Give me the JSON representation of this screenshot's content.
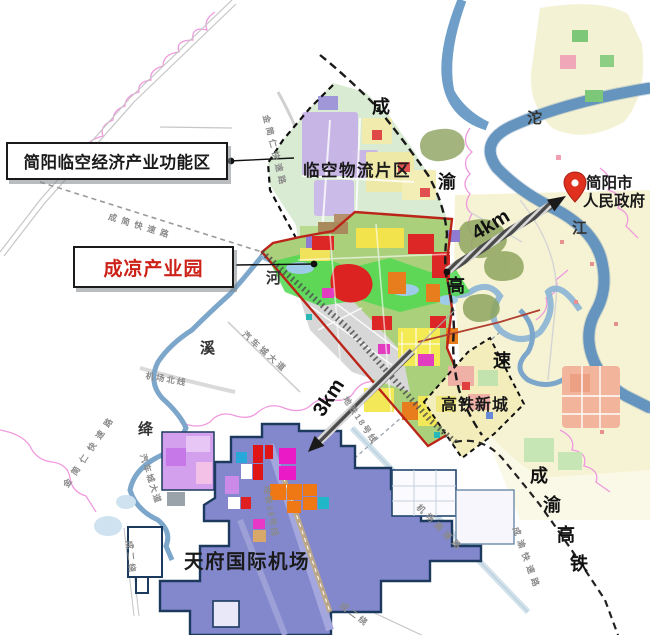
{
  "callouts": {
    "functional_zone": {
      "label": "简阳临空经济产业功能区"
    },
    "industrial_park": {
      "label": "成凉产业园"
    }
  },
  "area_labels": {
    "logistics_district": "临空物流片区",
    "hsr_new_town": "高铁新城",
    "airport": "天府国际机场",
    "government": {
      "line1": "简阳市",
      "line2": "人民政府"
    }
  },
  "distances": {
    "to_government": "4km",
    "to_airport": "3km"
  },
  "roads": {
    "chengyu_expressway_chars": [
      "成",
      "渝",
      "高",
      "速"
    ],
    "chengyu_hsr_chars": [
      "成",
      "渝",
      "高",
      "铁"
    ],
    "chengjian_expressway": "成简快速路",
    "jinjianren_expressway": "金简仁快速路",
    "auto_city_avenue": "汽车城大道",
    "airport_north_line": "机场北线",
    "metro_line_18": "地铁18号线",
    "airport_expressway": "机场高速路",
    "chengyu_rapid_road": "成渝快速路",
    "second_ring_expressway": "成二绕"
  },
  "rivers": {
    "tuo_river_chars": [
      "沱",
      "江"
    ],
    "jiangxi_river_chars": [
      "河",
      "溪",
      "绛"
    ]
  },
  "colors": {
    "park_boundary_red": "#bb2418",
    "callout_text_red": "#cc2218",
    "airport_purple": "#8388cd",
    "river_blue": "#6f9fc8",
    "pin_red": "#e0301e"
  }
}
